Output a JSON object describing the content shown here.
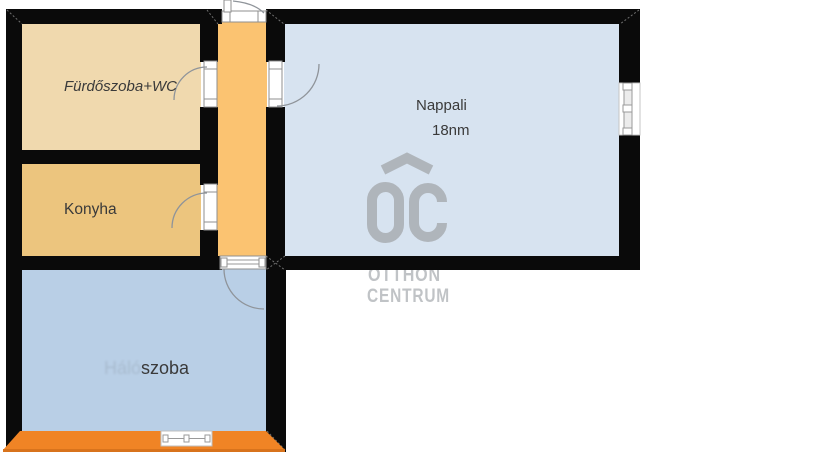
{
  "rooms": {
    "bathroom": {
      "label": "Fürdőszoba+WC",
      "color": "#f0d9ae"
    },
    "kitchen": {
      "label": "Konyha",
      "color": "#ecc57e"
    },
    "hallway": {
      "color": "#fbc371"
    },
    "living": {
      "label": "Nappali",
      "area": "18nm",
      "color": "#d7e3f0"
    },
    "bedroom": {
      "label": "szoba",
      "faded_prefix": "Háló",
      "color": "#b9cfe6"
    }
  },
  "watermark": {
    "line1": "OTTHON",
    "line2": "CENTRUM",
    "color": "#a9adb2",
    "text_color": "#b6b9bd"
  },
  "colors": {
    "wall": "#0a0a0a",
    "balcony": "#f08425",
    "balcony_edge": "#d8731c",
    "label_text": "#3a3a3a"
  }
}
